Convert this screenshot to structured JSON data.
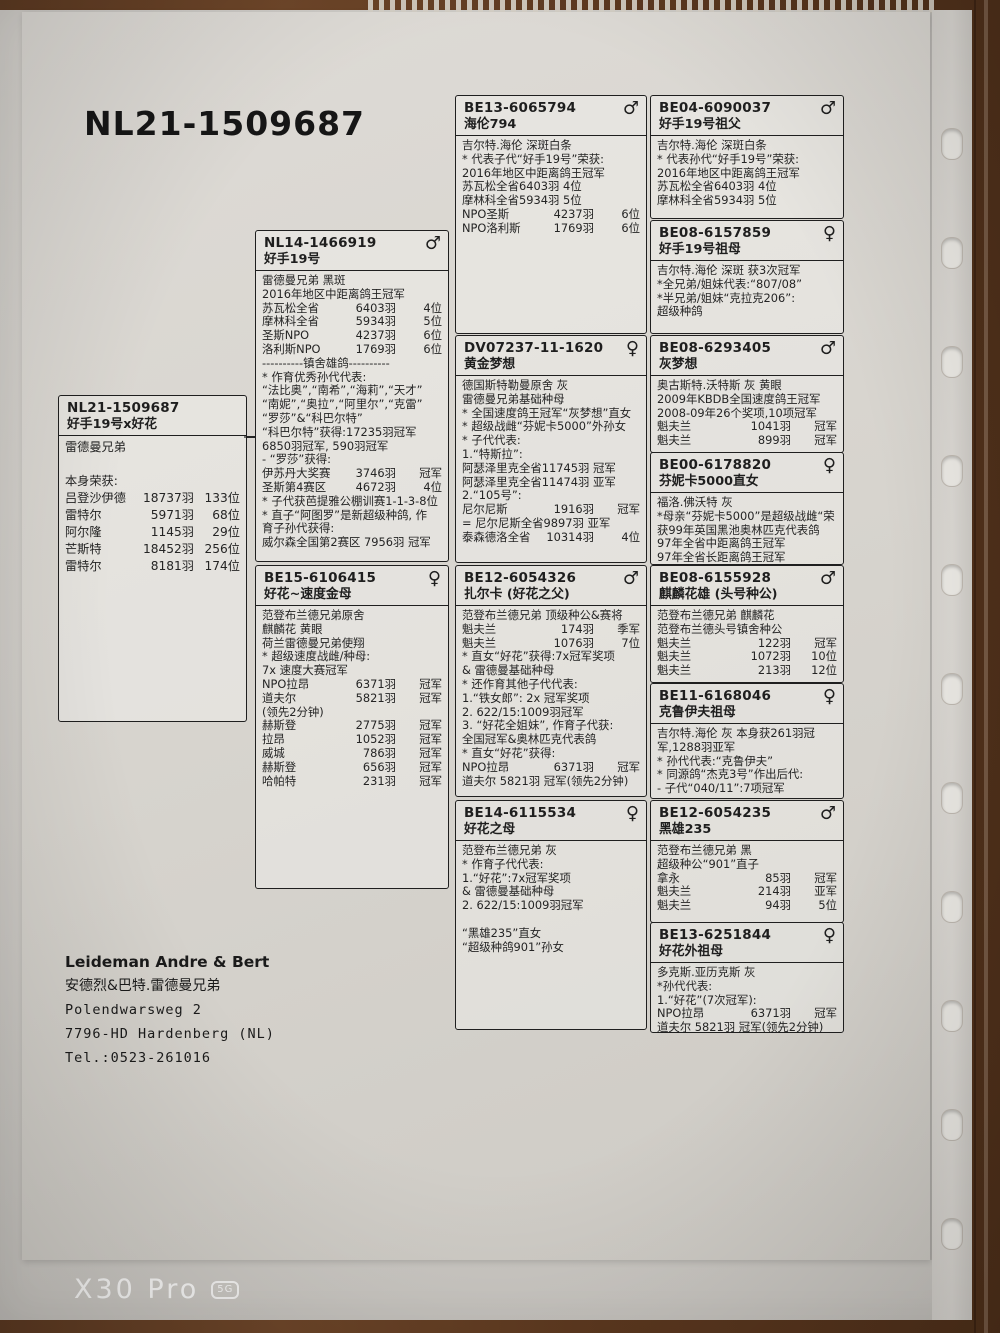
{
  "photo": {
    "watermark": {
      "model": "X30 Pro",
      "badge": "5G"
    },
    "colors": {
      "paper": "#d7d4ce",
      "wood": "#5c381f",
      "ink": "#1e1e1e"
    }
  },
  "document": {
    "title": "NL21-1509687",
    "sex_symbols": {
      "male": "♂",
      "female": "♀"
    },
    "owner": {
      "name": "Leideman Andre & Bert",
      "name_cn": "安德烈&巴特.雷德曼兄弟",
      "street": "Polendwarsweg 2",
      "city": "7796-HD Hardenberg  (NL)",
      "tel": "Tel.:0523-261016"
    },
    "boxes": [
      {
        "slot": "subject",
        "ring": "NL21-1509687",
        "name": "好手19号x好花",
        "sex": "",
        "lines": [
          "雷德曼兄弟",
          "",
          "本身荣获:",
          [
            "吕登沙伊德",
            "18737羽",
            "133位"
          ],
          [
            "雷特尔",
            "5971羽",
            "68位"
          ],
          [
            "阿尔隆",
            "1145羽",
            "29位"
          ],
          [
            "芒斯特",
            "18452羽",
            "256位"
          ],
          [
            "雷特尔",
            "8181羽",
            "174位"
          ]
        ]
      },
      {
        "slot": "sire",
        "ring": "NL14-1466919",
        "name": "好手19号",
        "sex": "male",
        "lines": [
          "雷德曼兄弟 黑斑",
          "2016年地区中距离鸽王冠军",
          [
            "苏瓦松全省",
            "6403羽",
            "4位"
          ],
          [
            "摩林科全省",
            "5934羽",
            "5位"
          ],
          [
            "圣斯NPO",
            "4237羽",
            "6位"
          ],
          [
            "洛利斯NPO",
            "1769羽",
            "6位"
          ],
          "----------镇舍雄鸽----------",
          "* 作育优秀孙代代表:",
          "“法比奥”,“南希”,“海莉”,“天才”",
          "“南妮”,“奥拉”,“阿里尔”,“克雷”",
          "“罗莎”&“科巴尔特”",
          "“科巴尔特”获得:17235羽冠军",
          "6850羽冠军, 590羽冠军",
          "- “罗莎”获得:",
          [
            "伊苏丹大奖赛",
            "3746羽",
            "冠军"
          ],
          [
            "圣斯第4赛区",
            "4672羽",
            "4位"
          ],
          "* 子代获芭提雅公棚训赛1-1-3-8位",
          "* 直子“阿图罗”是新超级种鸽, 作",
          "育子孙代获得:",
          "威尔森全国第2赛区 7956羽 冠军"
        ]
      },
      {
        "slot": "dam",
        "ring": "BE15-6106415",
        "name": "好花~速度金母",
        "sex": "female",
        "lines": [
          "范登布兰德兄弟原舍",
          "麒麟花 黄眼",
          "荷兰雷德曼兄弟使翔",
          "* 超级速度战雌/种母:",
          "7x 速度大赛冠军",
          [
            "NPO拉昂",
            "6371羽",
            "冠军"
          ],
          [
            "道夫尔",
            "5821羽",
            "冠军"
          ],
          "(领先2分钟)",
          [
            "赫斯登",
            "2775羽",
            "冠军"
          ],
          [
            "拉昂",
            "1052羽",
            "冠军"
          ],
          [
            "威城",
            "786羽",
            "冠军"
          ],
          [
            "赫斯登",
            "656羽",
            "冠军"
          ],
          [
            "哈帕特",
            "231羽",
            "冠军"
          ]
        ]
      },
      {
        "slot": "ss",
        "ring": "BE13-6065794",
        "name": "海伦794",
        "sex": "male",
        "lines": [
          "吉尔特.海伦 深斑白条",
          "* 代表子代“好手19号”荣获:",
          "2016年地区中距离鸽王冠军",
          "苏瓦松全省6403羽 4位",
          "摩林科全省5934羽 5位",
          [
            "NPO圣斯",
            "4237羽",
            "6位"
          ],
          [
            "NPO洛利斯",
            "1769羽",
            "6位"
          ]
        ]
      },
      {
        "slot": "sd",
        "ring": "DV07237-11-1620",
        "name": "黄金梦想",
        "sex": "female",
        "lines": [
          "德国斯特勒曼原舍 灰",
          "雷德曼兄弟基础种母",
          "* 全国速度鸽王冠军“灰梦想”直女",
          "* 超级战雌“芬妮卡5000”外孙女",
          "* 子代代表:",
          "1.“特斯拉”:",
          "阿瑟泽里克全省11745羽 冠军",
          "阿瑟泽里克全省11474羽 亚军",
          "2.“105号”:",
          [
            "尼尔尼斯",
            "1916羽",
            "冠军"
          ],
          "= 尼尔尼斯全省9897羽 亚军",
          [
            "泰森德洛全省",
            "10314羽",
            "4位"
          ]
        ]
      },
      {
        "slot": "ds",
        "ring": "BE12-6054326",
        "name": "扎尔卡 (好花之父)",
        "sex": "male",
        "lines": [
          "范登布兰德兄弟 顶级种公&赛将",
          [
            "魁夫兰",
            "174羽",
            "季军"
          ],
          [
            "魁夫兰",
            "1076羽",
            "7位"
          ],
          "* 直女“好花”获得:7x冠军奖项",
          "& 雷德曼基础种母",
          "* 还作育其他子代代表:",
          "1.“铁女郎”: 2x 冠军奖项",
          "2. 622/15:1009羽冠军",
          "3. “好花全姐妹”, 作育子代获:",
          "全国冠军&奥林匹克代表鸽",
          "* 直女“好花”获得:",
          [
            "NPO拉昂",
            "6371羽",
            "冠军"
          ],
          "道夫尔  5821羽 冠军(领先2分钟)"
        ]
      },
      {
        "slot": "dd",
        "ring": "BE14-6115534",
        "name": "好花之母",
        "sex": "female",
        "lines": [
          "范登布兰德兄弟 灰",
          "* 作育子代代表:",
          "1.“好花”:7x冠军奖项",
          "& 雷德曼基础种母",
          "2. 622/15:1009羽冠军",
          "",
          "“黑雄235”直女",
          "“超级种鸽901”孙女"
        ]
      },
      {
        "slot": "sss",
        "ring": "BE04-6090037",
        "name": "好手19号祖父",
        "sex": "male",
        "lines": [
          "吉尔特.海伦 深斑白条",
          "* 代表孙代“好手19号”荣获:",
          "2016年地区中距离鸽王冠军",
          "苏瓦松全省6403羽 4位",
          "摩林科全省5934羽 5位"
        ]
      },
      {
        "slot": "ssd",
        "ring": "BE08-6157859",
        "name": "好手19号祖母",
        "sex": "female",
        "lines": [
          "吉尔特.海伦 深斑 获3次冠军",
          "*全兄弟/姐妹代表:“807/08”",
          "*半兄弟/姐妹“克拉克206”:",
          "超级种鸽"
        ]
      },
      {
        "slot": "sds",
        "ring": "BE08-6293405",
        "name": "灰梦想",
        "sex": "male",
        "lines": [
          "奥古斯特.沃特斯 灰 黄眼",
          "2009年KBDB全国速度鸽王冠军",
          "2008-09年26个奖项,10项冠军",
          [
            "魁夫兰",
            "1041羽",
            "冠军"
          ],
          [
            "魁夫兰",
            "899羽",
            "冠军"
          ]
        ]
      },
      {
        "slot": "sdd",
        "ring": "BE00-6178820",
        "name": "芬妮卡5000直女",
        "sex": "female",
        "lines": [
          "福洛.佛沃特 灰",
          "*母亲“芬妮卡5000”是超级战雌“荣",
          "获99年英国黑池奥林匹克代表鸽",
          "97年全省中距离鸽王冠军",
          "97年全省长距离鸽王冠军"
        ]
      },
      {
        "slot": "dss",
        "ring": "BE08-6155928",
        "name": "麒麟花雄 (头号种公)",
        "sex": "male",
        "lines": [
          "范登布兰德兄弟 麒麟花",
          "范登布兰德头号镇舍种公",
          [
            "魁夫兰",
            "122羽",
            "冠军"
          ],
          [
            "魁夫兰",
            "1072羽",
            "10位"
          ],
          [
            "魁夫兰",
            "213羽",
            "12位"
          ]
        ]
      },
      {
        "slot": "dsd",
        "ring": "BE11-6168046",
        "name": "克鲁伊夫祖母",
        "sex": "female",
        "lines": [
          "吉尔特.海伦 灰 本身获261羽冠",
          "军,1288羽亚军",
          "* 孙代代表:“克鲁伊夫”",
          "* 同源鸽“杰克3号”作出后代:",
          "- 子代“040/11”:7项冠军"
        ]
      },
      {
        "slot": "dds",
        "ring": "BE12-6054235",
        "name": "黑雄235",
        "sex": "male",
        "lines": [
          "范登布兰德兄弟 黑",
          "超级种公“901”直子",
          [
            "拿永",
            "85羽",
            "冠军"
          ],
          [
            "魁夫兰",
            "214羽",
            "亚军"
          ],
          [
            "魁夫兰",
            "94羽",
            "5位"
          ]
        ]
      },
      {
        "slot": "ddd",
        "ring": "BE13-6251844",
        "name": "好花外祖母",
        "sex": "female",
        "lines": [
          "多克斯.亚历克斯 灰",
          "*孙代代表:",
          "1.“好花”(7次冠军):",
          [
            "NPO拉昂",
            "6371羽",
            "冠军"
          ],
          "道夫尔  5821羽 冠军(领先2分钟)"
        ]
      }
    ]
  }
}
